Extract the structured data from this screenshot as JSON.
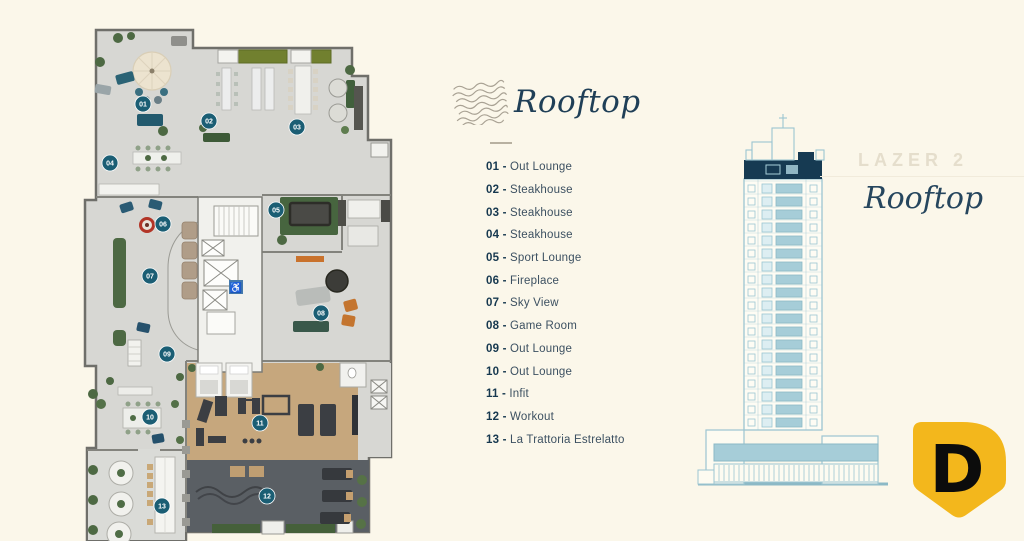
{
  "legend": {
    "title": "Rooftop",
    "separator": " - ",
    "items": [
      {
        "num": "01",
        "label": "Out Lounge"
      },
      {
        "num": "02",
        "label": "Steakhouse"
      },
      {
        "num": "03",
        "label": "Steakhouse"
      },
      {
        "num": "04",
        "label": "Steakhouse"
      },
      {
        "num": "05",
        "label": "Sport Lounge"
      },
      {
        "num": "06",
        "label": "Fireplace"
      },
      {
        "num": "07",
        "label": "Sky View"
      },
      {
        "num": "08",
        "label": "Game Room"
      },
      {
        "num": "09",
        "label": "Out Lounge"
      },
      {
        "num": "10",
        "label": "Out Lounge"
      },
      {
        "num": "11",
        "label": "Infit"
      },
      {
        "num": "12",
        "label": "Workout"
      },
      {
        "num": "13",
        "label": "La Trattoria Estrelatto"
      }
    ]
  },
  "right_panel": {
    "label": "LAZER 2",
    "title": "Rooftop"
  },
  "logo": {
    "letter": "D"
  },
  "floor_plan": {
    "markers": [
      {
        "num": "01",
        "x": 143,
        "y": 104
      },
      {
        "num": "02",
        "x": 209,
        "y": 121
      },
      {
        "num": "03",
        "x": 297,
        "y": 127
      },
      {
        "num": "04",
        "x": 110,
        "y": 163
      },
      {
        "num": "05",
        "x": 276,
        "y": 210
      },
      {
        "num": "06",
        "x": 163,
        "y": 224
      },
      {
        "num": "07",
        "x": 150,
        "y": 276
      },
      {
        "num": "08",
        "x": 321,
        "y": 313
      },
      {
        "num": "09",
        "x": 167,
        "y": 354
      },
      {
        "num": "10",
        "x": 150,
        "y": 417
      },
      {
        "num": "11",
        "x": 260,
        "y": 423
      },
      {
        "num": "12",
        "x": 267,
        "y": 496
      },
      {
        "num": "13",
        "x": 162,
        "y": 506
      }
    ]
  },
  "colors": {
    "background": "#fbf7ea",
    "marker": "#1b5e74",
    "marker_text": "#ffffff",
    "navy_band": "#163a52",
    "elevation_blue": "#9cc5d1",
    "elevation_fill": "#a6cdd8",
    "logo_yellow": "#f3b71c",
    "floor_gray": "#d7d7d3",
    "gym_wood": "#c6a77d",
    "workout_dark": "#5a5f64",
    "plant_green": "#4d6943",
    "fireplace_red": "#b23527"
  }
}
